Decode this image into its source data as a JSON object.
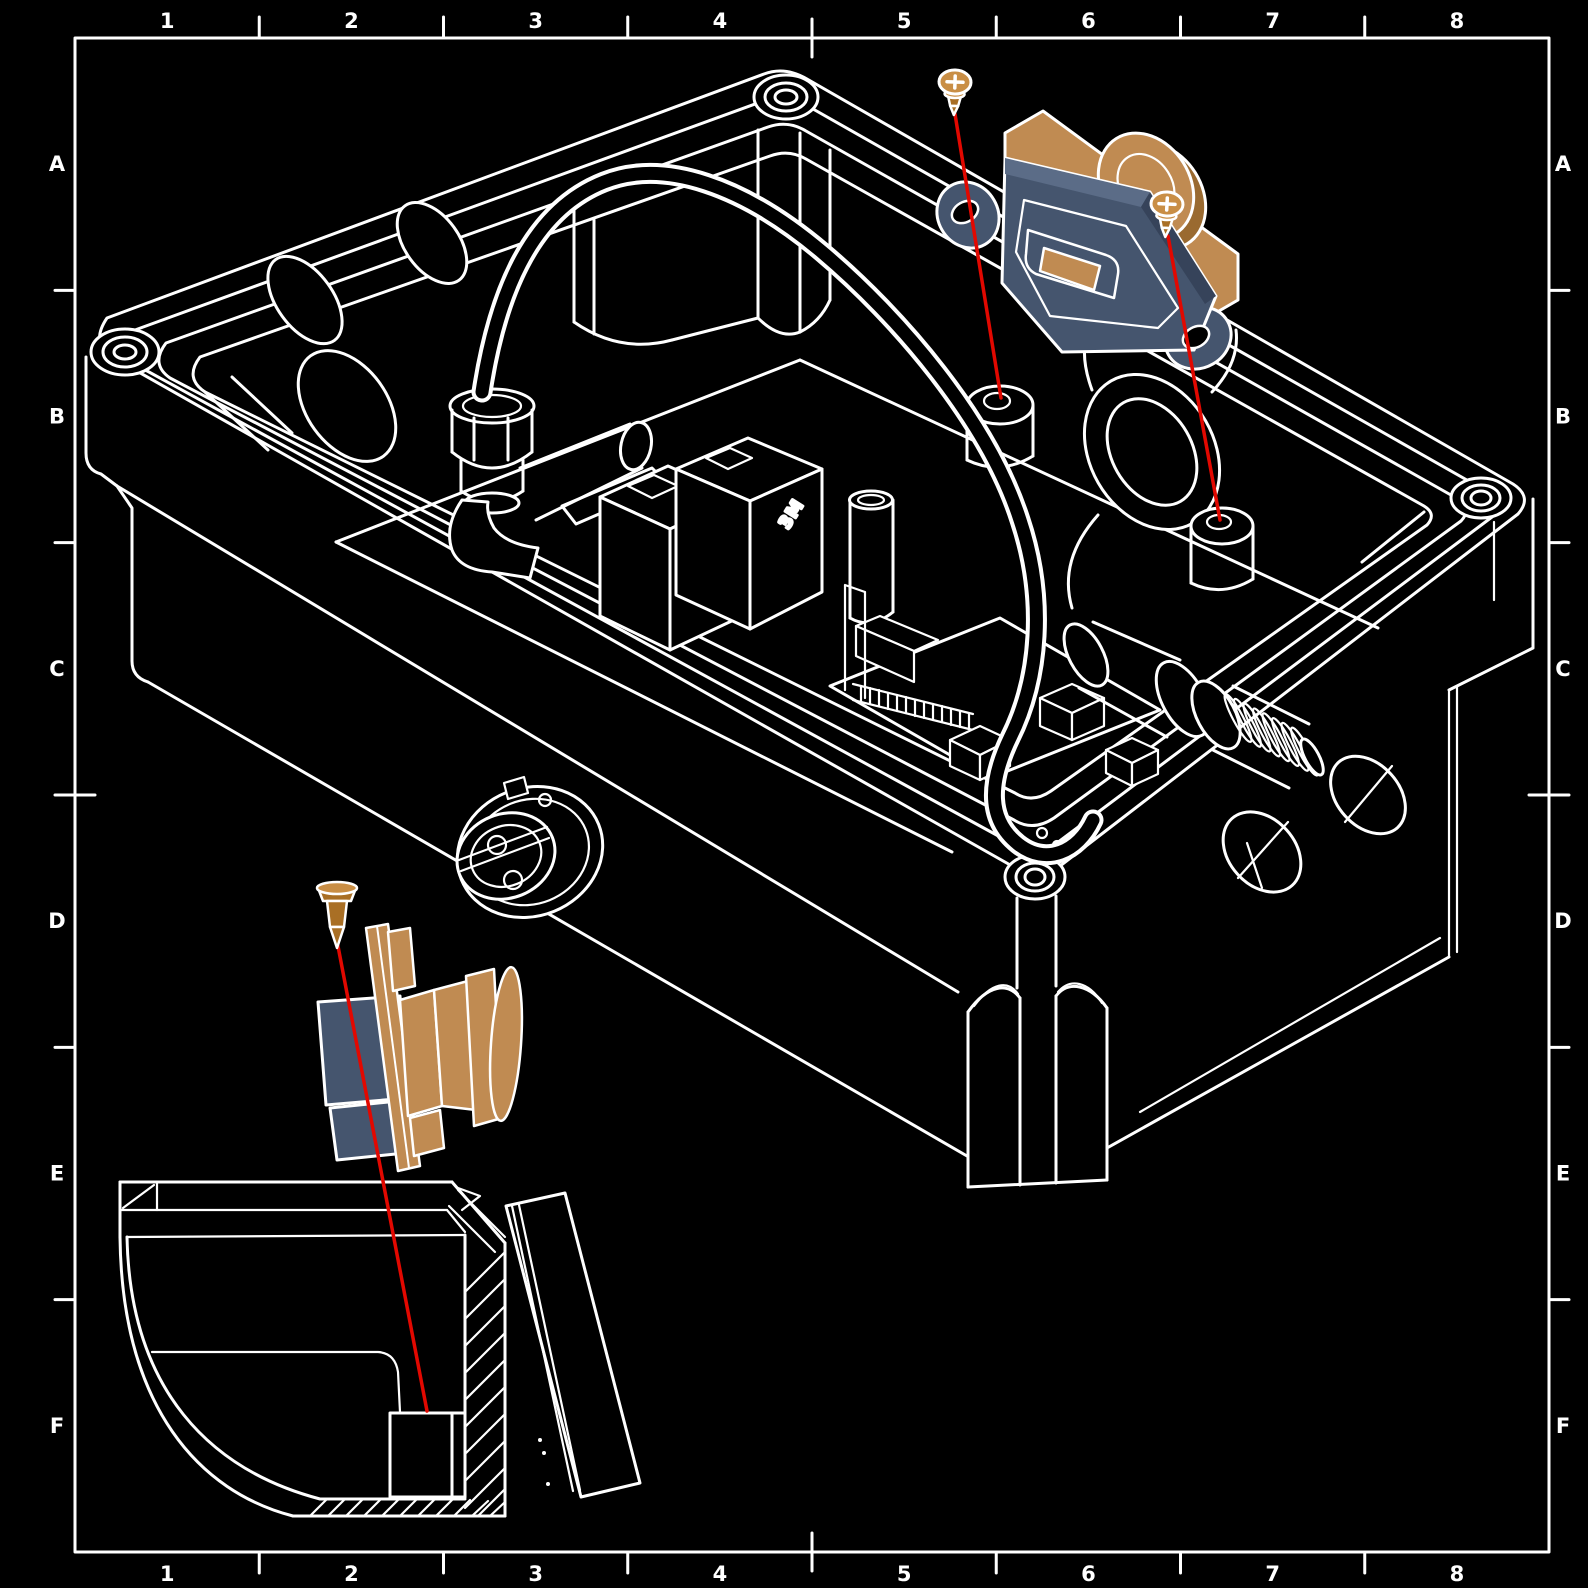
{
  "document": {
    "type": "technical-drawing",
    "style": "exploded-assembly-isometric-enclosure",
    "background": "#000000"
  },
  "border": {
    "columns": [
      "1",
      "2",
      "3",
      "4",
      "5",
      "6",
      "7",
      "8"
    ],
    "rows": [
      "A",
      "B",
      "C",
      "D",
      "E",
      "F"
    ]
  },
  "labels": {
    "relay_brand": "3M"
  },
  "colors": {
    "background": "#000000",
    "line": "#ffffff",
    "red_leader": "#e20800",
    "slate": "#45556e",
    "slate_light": "#5b6c87",
    "slate_dark": "#36435a",
    "tan": "#c08b52",
    "tan_light": "#cfa26a",
    "tan_dark": "#9a6a30",
    "screw_body": "#a96f25",
    "screw_light": "#c98e45"
  },
  "parts": {
    "highlighted_components": [
      "panel-mount-bracket",
      "connector-module",
      "mounting-screw",
      "mounting-screw",
      "seal-pin",
      "panel-connector-plug"
    ],
    "leader_lines": 3,
    "section_detail": "corner-cross-section-with-hatching"
  }
}
